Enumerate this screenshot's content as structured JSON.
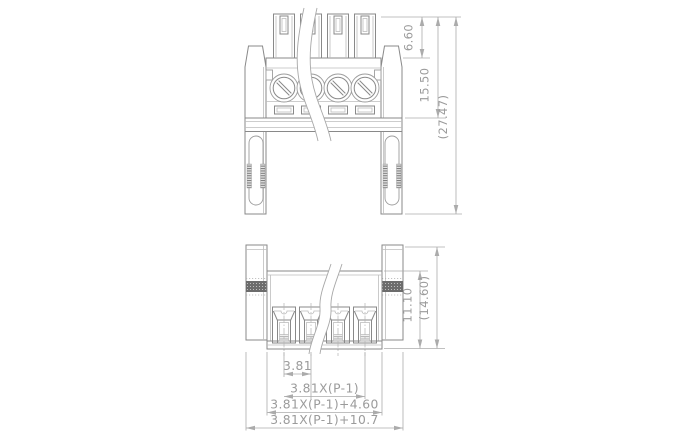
{
  "colors": {
    "background": "#ffffff",
    "outline": "#898989",
    "light_line": "#bdbdbd",
    "dimension_line": "#ababab",
    "dimension_text": "#9b9b9b",
    "knurl_band": "#6c6c6c"
  },
  "dimensions": {
    "front_view": {
      "plug_height": "6.60",
      "header_height": "15.50",
      "overall_height": "(27.47)"
    },
    "bottom_view": {
      "body_height": "11.10",
      "overall_height": "(14.60)"
    },
    "width": {
      "pitch": "3.81",
      "pole_span": "3.81X(P-1)",
      "body_width": "3.81X(P-1)+4.60",
      "overall_width": "3.81X(P-1)+10.7"
    }
  }
}
